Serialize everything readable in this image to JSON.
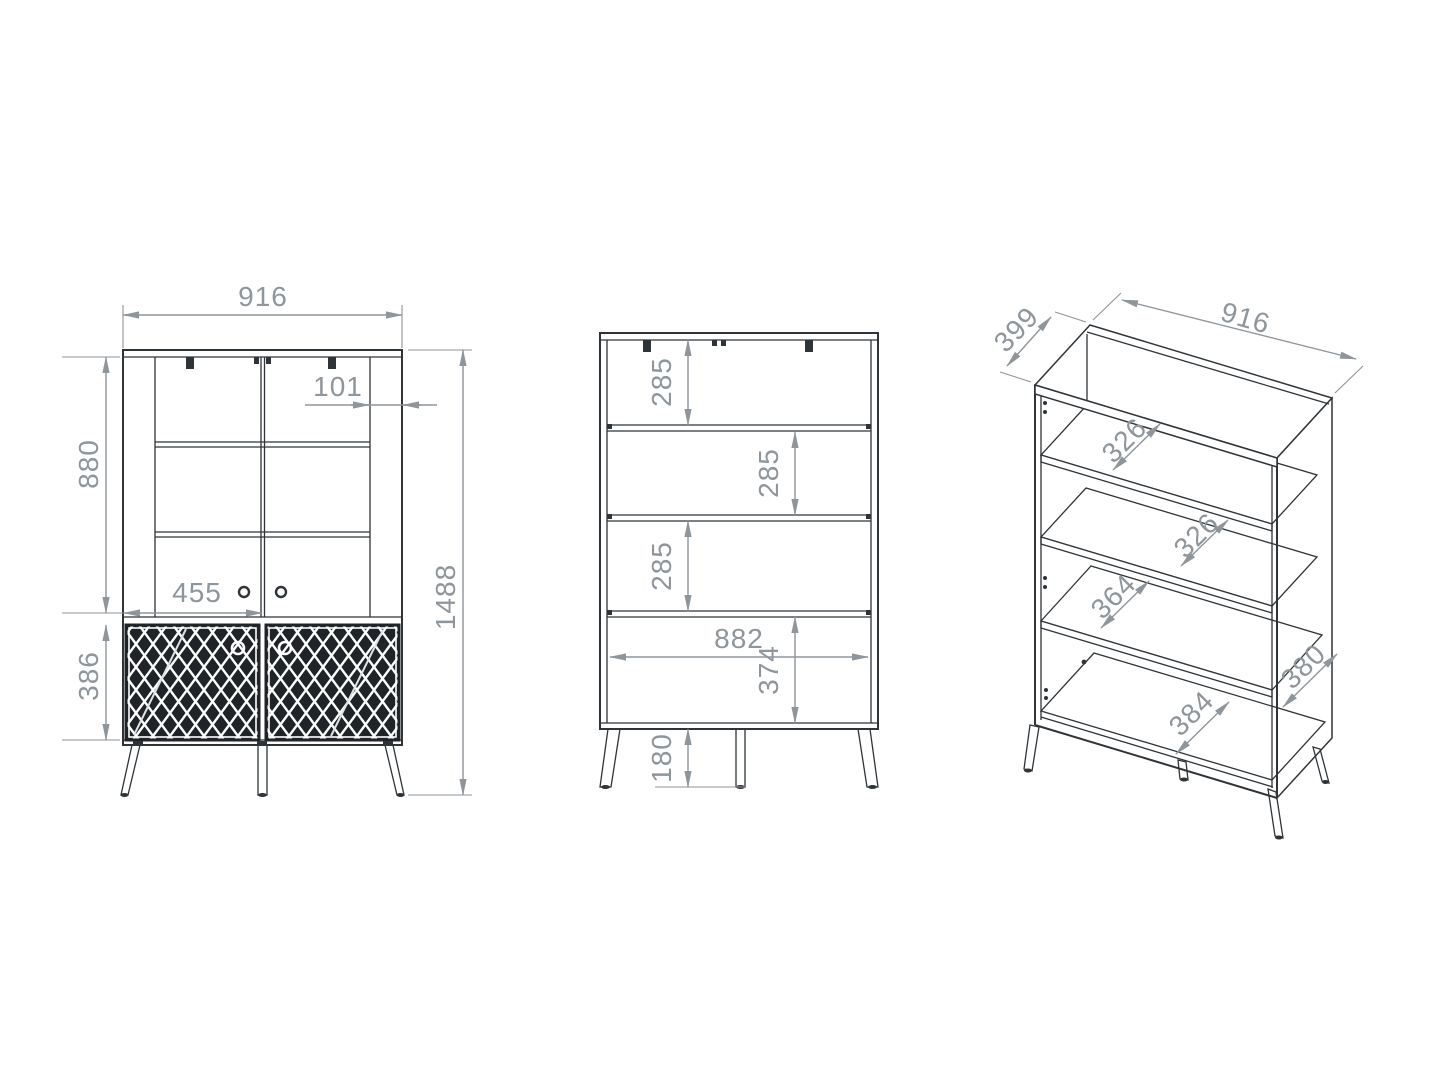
{
  "front_view": {
    "label": "front view with doors",
    "width": "916",
    "side_panel_width": "101",
    "vitrine_height": "880",
    "door_width": "455",
    "base_height": "386",
    "total_height": "1488"
  },
  "open_view": {
    "label": "front view without doors",
    "shelf_spacing_top": "285",
    "shelf_spacing_middle": "285",
    "shelf_spacing_bottom": "285",
    "interior_width": "882",
    "base_interior_height": "374",
    "leg_height": "180"
  },
  "iso_view": {
    "label": "isometric view",
    "depth": "399",
    "width": "916",
    "shelf_depth_top": "326",
    "shelf_depth_middle": "326",
    "shelf_depth_lower": "364",
    "side_panel_depth": "380",
    "bottom_depth": "384"
  },
  "colors": {
    "line": "#2f3438",
    "dimension": "#8e959b",
    "lattice_background": "#202428",
    "background": "#ffffff"
  }
}
